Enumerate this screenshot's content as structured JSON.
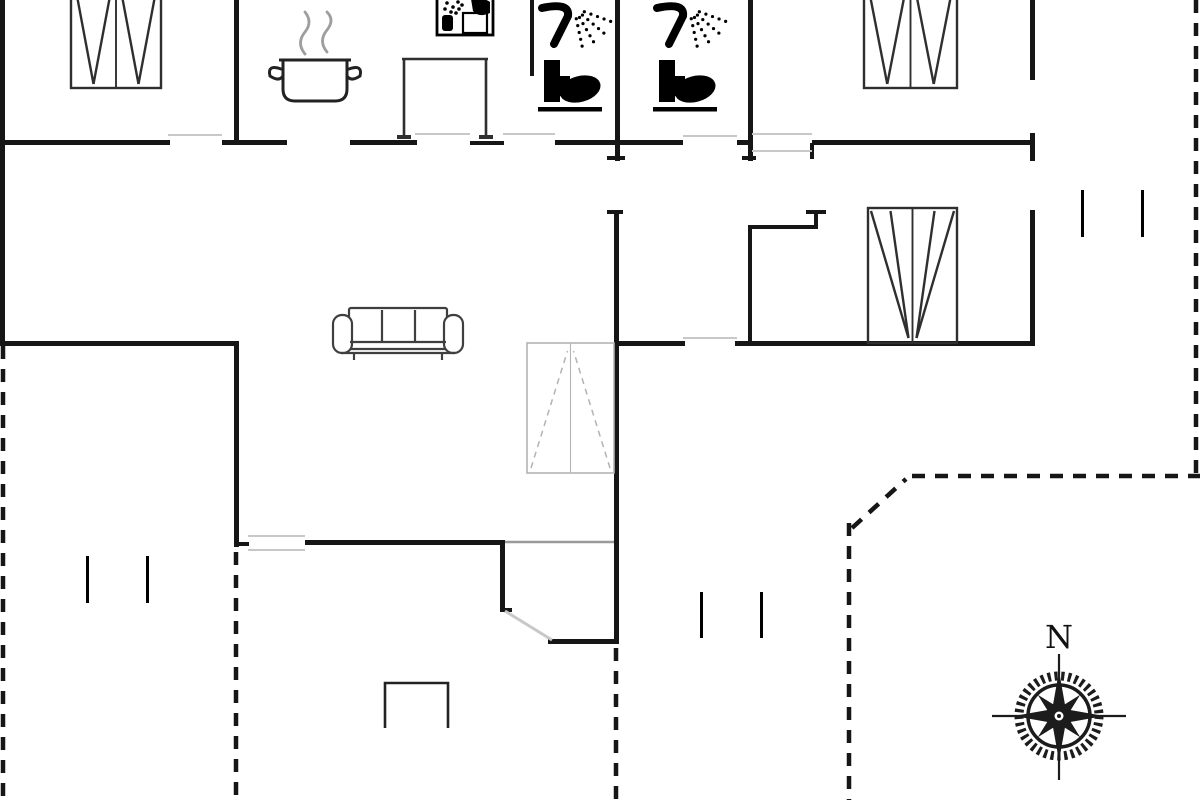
{
  "title": "holiday-house-floor-plan",
  "canvas": {
    "width": 1200,
    "height": 800
  },
  "colors": {
    "wall": "#161616",
    "black": "#000000",
    "furniture": "#2f2f2f",
    "sofa": "#3f3f3f",
    "light": "#c8c8c8",
    "medium": "#9a9a9a",
    "gray_bed": "#b4b4b4",
    "steam": "#9e9e9e",
    "bg": "#ffffff"
  },
  "compass": {
    "label": "N",
    "cx": 1059,
    "cy": 716
  },
  "walls": [
    {
      "name": "top-wall-a",
      "x": 0,
      "y": 140,
      "w": 170,
      "h": 5
    },
    {
      "name": "top-wall-b",
      "x": 222,
      "y": 140,
      "w": 65,
      "h": 5
    },
    {
      "name": "top-wall-c",
      "x": 350,
      "y": 140,
      "w": 67,
      "h": 5
    },
    {
      "name": "top-wall-d",
      "x": 470,
      "y": 141,
      "w": 34,
      "h": 4
    },
    {
      "name": "top-wall-e",
      "x": 555,
      "y": 140,
      "w": 128,
      "h": 5
    },
    {
      "name": "top-wall-f",
      "x": 737,
      "y": 140,
      "w": 16,
      "h": 5
    },
    {
      "name": "top-wall-g",
      "x": 812,
      "y": 140,
      "w": 222,
      "h": 5
    },
    {
      "name": "exterior-left-wall",
      "x": 0,
      "y": 0,
      "w": 5,
      "h": 346
    },
    {
      "name": "bedroom1-east-wall",
      "x": 234,
      "y": 0,
      "w": 5,
      "h": 145
    },
    {
      "name": "sink-stub-wall",
      "x": 530,
      "y": 0,
      "w": 4,
      "h": 76
    },
    {
      "name": "bath-divider-wall",
      "x": 615,
      "y": 0,
      "w": 5,
      "h": 161
    },
    {
      "name": "bath2-east-wall",
      "x": 748,
      "y": 0,
      "w": 5,
      "h": 161
    },
    {
      "name": "hall-stub-wall",
      "x": 810,
      "y": 143,
      "w": 4,
      "h": 16
    },
    {
      "name": "bedroom2-east-wall-upper",
      "x": 1030,
      "y": 0,
      "w": 5,
      "h": 80
    },
    {
      "name": "bedroom2-east-stub",
      "x": 1030,
      "y": 133,
      "w": 5,
      "h": 28
    },
    {
      "name": "living-east-wall",
      "x": 614,
      "y": 210,
      "w": 5,
      "h": 434
    },
    {
      "name": "bedroom3-east-wall",
      "x": 1030,
      "y": 210,
      "w": 5,
      "h": 136
    },
    {
      "name": "mid-wall-west",
      "x": 0,
      "y": 341,
      "w": 239,
      "h": 5
    },
    {
      "name": "mid-wall-center",
      "x": 614,
      "y": 341,
      "w": 71,
      "h": 5
    },
    {
      "name": "mid-wall-east",
      "x": 735,
      "y": 341,
      "w": 300,
      "h": 5
    },
    {
      "name": "living-west-wall",
      "x": 234,
      "y": 341,
      "w": 5,
      "h": 206
    },
    {
      "name": "living-south-wall",
      "x": 305,
      "y": 540,
      "w": 200,
      "h": 5
    },
    {
      "name": "vestibule-west-wall",
      "x": 500,
      "y": 540,
      "w": 5,
      "h": 72
    },
    {
      "name": "vestibule-south-wall",
      "x": 548,
      "y": 639,
      "w": 70,
      "h": 5
    },
    {
      "name": "closet-north-wall",
      "x": 748,
      "y": 225,
      "w": 70,
      "h": 4
    },
    {
      "name": "closet-west-wall",
      "x": 748,
      "y": 225,
      "w": 4,
      "h": 120
    },
    {
      "name": "closet-stub-v",
      "x": 814,
      "y": 210,
      "w": 4,
      "h": 19
    },
    {
      "name": "closet-stub-h",
      "x": 806,
      "y": 210,
      "w": 20,
      "h": 4
    },
    {
      "name": "wall-end-tick-a",
      "x": 607,
      "y": 156,
      "w": 18,
      "h": 4
    },
    {
      "name": "wall-end-tick-b",
      "x": 742,
      "y": 156,
      "w": 14,
      "h": 4
    },
    {
      "name": "wall-end-tick-c",
      "x": 1019,
      "y": 141,
      "w": 12,
      "h": 4
    },
    {
      "name": "wall-end-tick-d",
      "x": 607,
      "y": 210,
      "w": 16,
      "h": 4
    },
    {
      "name": "wall-end-tick-e",
      "x": 234,
      "y": 542,
      "w": 15,
      "h": 4
    },
    {
      "name": "wall-end-tick-f",
      "x": 500,
      "y": 608,
      "w": 12,
      "h": 4
    }
  ],
  "terrace_ticks": [
    {
      "name": "terrace-tick-west-1",
      "x": 86,
      "y": 556,
      "w": 3,
      "h": 47
    },
    {
      "name": "terrace-tick-west-2",
      "x": 146,
      "y": 556,
      "w": 3,
      "h": 47
    },
    {
      "name": "terrace-tick-south-1",
      "x": 700,
      "y": 592,
      "w": 3,
      "h": 46
    },
    {
      "name": "terrace-tick-south-2",
      "x": 760,
      "y": 592,
      "w": 3,
      "h": 46
    },
    {
      "name": "terrace-tick-east-1",
      "x": 1081,
      "y": 190,
      "w": 3,
      "h": 47
    },
    {
      "name": "terrace-tick-east-2",
      "x": 1141,
      "y": 190,
      "w": 3,
      "h": 47
    }
  ],
  "openings": [
    {
      "name": "door-bedroom1",
      "x1": 168,
      "y1": 135,
      "x2": 222,
      "y2": 135,
      "w": 2,
      "c": "light"
    },
    {
      "name": "door-kitchen",
      "x1": 415,
      "y1": 134,
      "x2": 470,
      "y2": 134,
      "w": 2,
      "c": "light"
    },
    {
      "name": "door-bath1",
      "x1": 503,
      "y1": 134,
      "x2": 555,
      "y2": 134,
      "w": 2,
      "c": "light"
    },
    {
      "name": "door-hall",
      "x1": 683,
      "y1": 136,
      "x2": 737,
      "y2": 136,
      "w": 2,
      "c": "light"
    },
    {
      "name": "door-bedroom2-a",
      "x1": 752,
      "y1": 134,
      "x2": 812,
      "y2": 134,
      "w": 2,
      "c": "light"
    },
    {
      "name": "door-bedroom2-b",
      "x1": 752,
      "y1": 151,
      "x2": 812,
      "y2": 151,
      "w": 2,
      "c": "light"
    },
    {
      "name": "door-bedroom3",
      "x1": 683,
      "y1": 338,
      "x2": 737,
      "y2": 338,
      "w": 2,
      "c": "light"
    },
    {
      "name": "vestibule-opening",
      "x1": 505,
      "y1": 542,
      "x2": 614,
      "y2": 542,
      "w": 2.5,
      "c": "medium"
    },
    {
      "name": "door-living-a",
      "x1": 248,
      "y1": 536,
      "x2": 305,
      "y2": 536,
      "w": 2,
      "c": "light"
    },
    {
      "name": "door-living-b",
      "x1": 248,
      "y1": 550,
      "x2": 305,
      "y2": 550,
      "w": 2,
      "c": "light"
    },
    {
      "name": "entrance-door-swing",
      "x1": 505,
      "y1": 611,
      "x2": 552,
      "y2": 640,
      "w": 3,
      "c": "light"
    }
  ],
  "dashed_lines": [
    {
      "name": "terrace-west-edge",
      "x1": 3,
      "y1": 346,
      "x2": 3,
      "y2": 800
    },
    {
      "name": "terrace-west-inner-edge",
      "x1": 236,
      "y1": 552,
      "x2": 236,
      "y2": 800
    },
    {
      "name": "terrace-south-mid-edge",
      "x1": 616,
      "y1": 648,
      "x2": 616,
      "y2": 800
    },
    {
      "name": "terrace-east-inner-edge",
      "x1": 849,
      "y1": 523,
      "x2": 849,
      "y2": 800
    },
    {
      "name": "terrace-corner-diagonal",
      "x1": 852,
      "y1": 528,
      "x2": 906,
      "y2": 479
    },
    {
      "name": "terrace-east-top-edge",
      "x1": 912,
      "y1": 476,
      "x2": 1200,
      "y2": 476
    },
    {
      "name": "terrace-east-edge",
      "x1": 1196,
      "y1": 0,
      "x2": 1196,
      "y2": 476
    }
  ],
  "beds": [
    {
      "name": "bed-bedroom1",
      "x": 71,
      "y": -22,
      "w": 90,
      "h": 110,
      "style": "solid",
      "apex": "half-bottom"
    },
    {
      "name": "bed-bedroom2",
      "x": 864,
      "y": -22,
      "w": 93,
      "h": 110,
      "style": "solid",
      "apex": "half-bottom"
    },
    {
      "name": "bed-bedroom3",
      "x": 868,
      "y": 208,
      "w": 89,
      "h": 135,
      "style": "solid",
      "apex": "center-bottom"
    },
    {
      "name": "bed-extra-gray",
      "x": 527,
      "y": 343,
      "w": 87,
      "h": 130,
      "style": "gray",
      "apex": "center-top"
    }
  ],
  "sofa": {
    "x": 333,
    "y": 306,
    "w": 130,
    "h": 52
  },
  "counter": {
    "x": 402,
    "y": 59,
    "w": 86,
    "h": 80
  },
  "pot": {
    "x": 283,
    "y": 60,
    "w": 64,
    "h": 41
  },
  "sink": {
    "x": 437,
    "y": -3,
    "w": 56,
    "h": 38
  },
  "showers": [
    {
      "name": "shower-bath1",
      "x": 542,
      "y": 2
    },
    {
      "name": "shower-bath2",
      "x": 657,
      "y": 2
    }
  ],
  "toilets": [
    {
      "name": "toilet-bath1",
      "x": 540,
      "y": 60
    },
    {
      "name": "toilet-bath2",
      "x": 655,
      "y": 60
    }
  ],
  "step": {
    "x": 385,
    "y": 683,
    "w": 63,
    "h": 45
  }
}
